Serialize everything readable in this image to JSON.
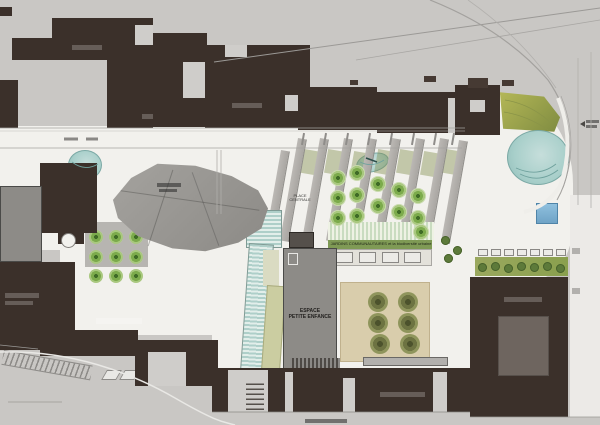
{
  "title": "Site landscape master plan",
  "labels": {
    "place_line1": "PLACE",
    "place_line2": "CENTRALE",
    "espace_line1": "ESPACE",
    "espace_line2": "PETITE ENFANCE",
    "jardins": "JARDINS COMMUNAUTAIRES et la biodiversité urbaine"
  },
  "palette": {
    "street_gray": "#c9c7c4",
    "plaza_white": "#f2f1ed",
    "building_dark": "#3b302a",
    "building_gray": "#8d8b87",
    "courtyard_tan": "#d9cdac",
    "pond_teal": "#a8cfca",
    "glass_teal": "#aecfc9",
    "ramp_olive": "#cbcda1",
    "tree_green": "#7cab4c",
    "tree_olive": "#6d7342",
    "grass_green": "#9aa85e",
    "slope_green": "#adb052",
    "basin_blue": "#7fb2d3"
  },
  "map": {
    "layers": [
      {
        "name": "plaza-bands",
        "class": "band",
        "w": 8,
        "h": 104,
        "points": [
          [
            298,
            138
          ],
          [
            320,
            138
          ],
          [
            344,
            138
          ],
          [
            368,
            138
          ],
          [
            392,
            138
          ],
          [
            416,
            138
          ],
          [
            440,
            138
          ],
          [
            459,
            140
          ],
          [
            281,
            150
          ]
        ]
      },
      {
        "name": "promenade-ticks",
        "class": "ptick",
        "w": 2,
        "h": 12,
        "points": [
          [
            302,
            133
          ],
          [
            324,
            133
          ],
          [
            346,
            133
          ],
          [
            368,
            133
          ],
          [
            390,
            133
          ],
          [
            412,
            133
          ],
          [
            434,
            133
          ],
          [
            452,
            133
          ]
        ]
      },
      {
        "name": "grass-patches",
        "class": "grass",
        "w": 14,
        "h": 24,
        "points": [
          [
            302,
            150
          ],
          [
            326,
            150
          ],
          [
            352,
            152
          ],
          [
            376,
            150
          ],
          [
            398,
            150
          ],
          [
            422,
            152
          ],
          [
            444,
            150
          ]
        ]
      },
      {
        "name": "bosque-trees",
        "class": "tree-b",
        "w": 16,
        "h": 16,
        "points": [
          [
            330,
            170
          ],
          [
            349,
            165
          ],
          [
            330,
            190
          ],
          [
            349,
            187
          ],
          [
            330,
            210
          ],
          [
            349,
            208
          ],
          [
            370,
            176
          ],
          [
            370,
            198
          ],
          [
            391,
            182
          ],
          [
            391,
            204
          ],
          [
            410,
            188
          ],
          [
            410,
            210
          ],
          [
            413,
            224
          ]
        ]
      },
      {
        "name": "grid-trees",
        "class": "tree-b",
        "w": 14,
        "h": 14,
        "points": [
          [
            89,
            230
          ],
          [
            109,
            230
          ],
          [
            129,
            230
          ],
          [
            89,
            250
          ],
          [
            109,
            250
          ],
          [
            129,
            250
          ],
          [
            89,
            269
          ],
          [
            109,
            269
          ],
          [
            129,
            269
          ]
        ]
      },
      {
        "name": "courtyard-trees",
        "class": "tree-o",
        "w": 20,
        "h": 20,
        "points": [
          [
            368,
            292
          ],
          [
            398,
            292
          ],
          [
            368,
            313
          ],
          [
            398,
            313
          ],
          [
            370,
            334
          ],
          [
            400,
            334
          ]
        ]
      },
      {
        "name": "hedge-trees",
        "class": "tree-s",
        "w": 9,
        "h": 9,
        "points": [
          [
            478,
            263
          ],
          [
            491,
            262
          ],
          [
            504,
            264
          ],
          [
            517,
            262
          ],
          [
            530,
            263
          ],
          [
            543,
            262
          ],
          [
            556,
            264
          ]
        ]
      },
      {
        "name": "edge-hedge-trees",
        "class": "tree-s",
        "w": 9,
        "h": 9,
        "points": [
          [
            441,
            236
          ],
          [
            453,
            246
          ],
          [
            444,
            254
          ]
        ]
      },
      {
        "name": "jardin-boxes",
        "class": "jbox",
        "w": 17,
        "h": 11,
        "points": [
          [
            336,
            252
          ],
          [
            359,
            252
          ],
          [
            382,
            252
          ],
          [
            404,
            252
          ]
        ]
      },
      {
        "name": "planter-ticks",
        "class": "jbox",
        "w": 10,
        "h": 7,
        "points": [
          [
            478,
            249
          ],
          [
            491,
            249
          ],
          [
            504,
            249
          ],
          [
            517,
            249
          ],
          [
            530,
            249
          ],
          [
            543,
            249
          ],
          [
            556,
            249
          ]
        ]
      }
    ]
  }
}
